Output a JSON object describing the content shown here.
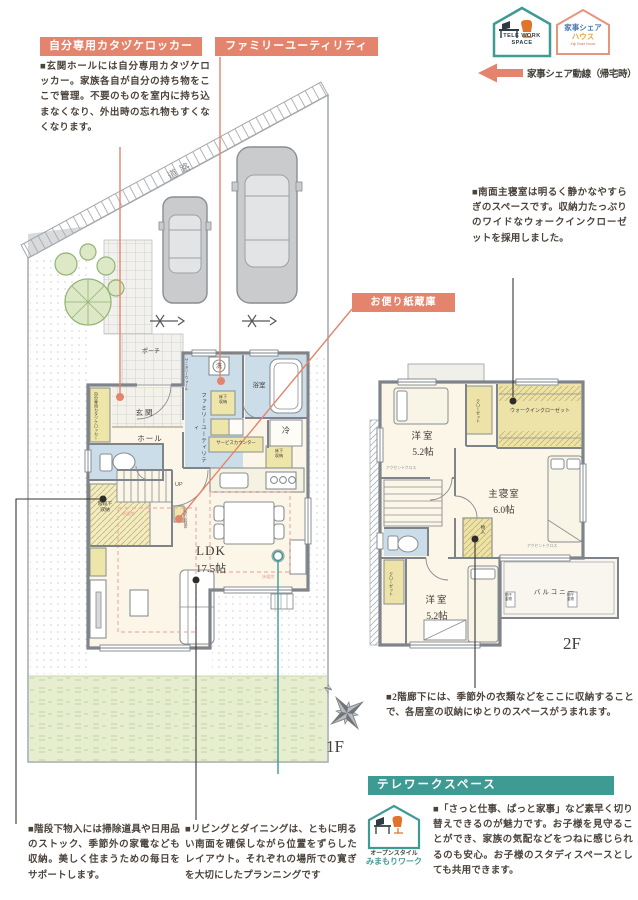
{
  "header": {
    "callout_locker": {
      "label": "自分専用カタヅケロッカー",
      "body": "■玄関ホールには自分専用カタヅケロッカー。家族各自が自分の持ち物をここで管理。不要のものを室内に持ち込まなくなり、外出時の忘れ物もすくなくなります。"
    },
    "callout_family_utility": {
      "label": "ファミリーユーティリティ"
    },
    "telework_badge": {
      "line1": "TELE WORK",
      "line2": "SPACE"
    },
    "kaji_badge": {
      "line1": "家事シェア",
      "line2": "ハウス",
      "sub": "Kaji Share House"
    },
    "flow_legend": "家事シェア動線（帰宅時）"
  },
  "callout_mail": {
    "label": "お便り紙蔵庫"
  },
  "notes": {
    "master_bedroom": "■南面主寝室は明るく静かなやすらぎのスペースです。収納力たっぷりのワイドなウォークインクローゼットを採用しました。",
    "hall_2f": "■2階廊下には、季節外の衣類などをここに収納することで、各居室の収納にゆとりのスペースがうまれます。",
    "under_stair": "■階段下物入には掃除道具や日用品のストック、季節外の家電なども収納。美しく住まうための毎日をサポートします。",
    "living_dining": "■リビングとダイニングは、ともに明るい南面を確保しながら位置をずらしたレイアウト。それぞれの場所での寛ぎを大切にしたプランニングです",
    "telework": "■「さっと仕事、ぱっと家事」など素早く切り替えできるのが魅力です。お子様を見守ることができ、家族の気配などをつねに感じられるのも安心。お子様のスタディスペースとしても共用できます。"
  },
  "telework_section": {
    "bar_label": "テレワークスペース",
    "badge_line1": "オープンスタイル",
    "badge_line2": "みまもりワーク"
  },
  "floor1": {
    "floor_label": "1F",
    "road": "道路",
    "porch": "ポーチ",
    "entrance": "玄関",
    "hall": "ホール",
    "locker": "自分専用カタヅケロッカー",
    "family_utility": "ファミリーユーティリティ",
    "sanitary_wall": "サニタリーウォール",
    "washer": "洗",
    "bath": "浴室",
    "fridge": "冷",
    "floor_storage": "床下収納",
    "service_counter": "サービスカウンター",
    "under_stair_storage": "階段下収納",
    "up": "UP",
    "ldk": "LDK",
    "ldk_size": "17.5帖",
    "floor_heating": "床暖房",
    "mail_storage_small": "お便り紙蔵庫"
  },
  "floor2": {
    "floor_label": "2F",
    "room_a": "洋室",
    "room_a_size": "5.2帖",
    "room_b": "洋室",
    "room_b_size": "5.2帖",
    "master": "主寝室",
    "master_size": "6.0帖",
    "closet": "クローゼット",
    "wic": "ウォークインクローゼット",
    "storage": "物入",
    "balcony": "バルコニー",
    "laundry_fitting": "物干金物",
    "accent_wall": "アクセントクロス"
  },
  "compass": {
    "north": "N"
  },
  "colors": {
    "accent_salmon": "#E5846C",
    "accent_teal": "#3E9B94",
    "text": "#4B433B"
  }
}
